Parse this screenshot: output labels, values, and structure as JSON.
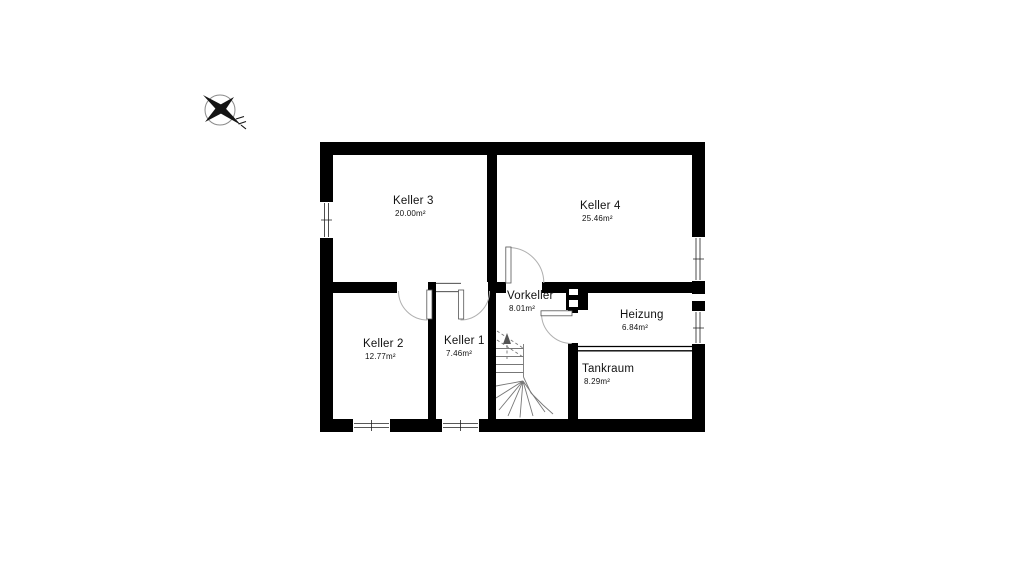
{
  "canvas": {
    "background": "#ffffff",
    "wall_color": "#000000",
    "door_arc_color": "#b0b0b0",
    "stair_line_color": "#777777"
  },
  "compass": {
    "icon": "compass-north-arrow"
  },
  "rooms": [
    {
      "id": "keller-3",
      "name": "Keller 3",
      "area": "20.00m²"
    },
    {
      "id": "keller-4",
      "name": "Keller 4",
      "area": "25.46m²"
    },
    {
      "id": "keller-2",
      "name": "Keller 2",
      "area": "12.77m²"
    },
    {
      "id": "keller-1",
      "name": "Keller 1",
      "area": "7.46m²"
    },
    {
      "id": "vorkeller",
      "name": "Vorkeller",
      "area": "8.01m²"
    },
    {
      "id": "heizung",
      "name": "Heizung",
      "area": "6.84m²"
    },
    {
      "id": "tankraum",
      "name": "Tankraum",
      "area": "8.29m²"
    }
  ]
}
